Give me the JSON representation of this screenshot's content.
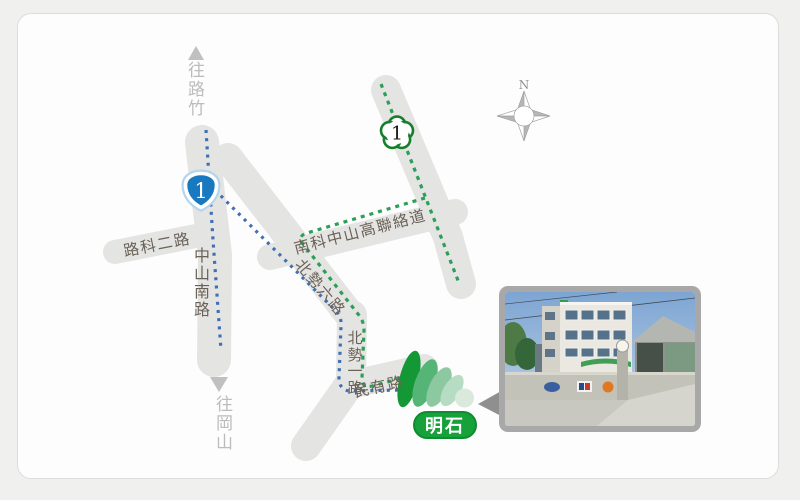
{
  "map": {
    "compass": {
      "north_label": "N"
    },
    "directions": {
      "north": "往路竹",
      "south": "往岡山"
    },
    "roads": {
      "nanke_connector": "南科中山高聯絡道",
      "luke_2nd": "路科二路",
      "zhongshan_south": "中山南路",
      "beishi_6th": "北勢六路",
      "beishi_1st": "北勢一路",
      "minyou": "民有路"
    },
    "shields": {
      "national_highway_1": "1",
      "provincial_highway_1": "1"
    },
    "destination": {
      "name": "明石"
    },
    "colors": {
      "road": "#e4e4e3",
      "route_blue": "#3e70b2",
      "route_green": "#2d9e57",
      "marker_green": "#16a13b",
      "national_shield_blue": "#1879c0",
      "provincial_shield_green": "#157f2c"
    }
  }
}
